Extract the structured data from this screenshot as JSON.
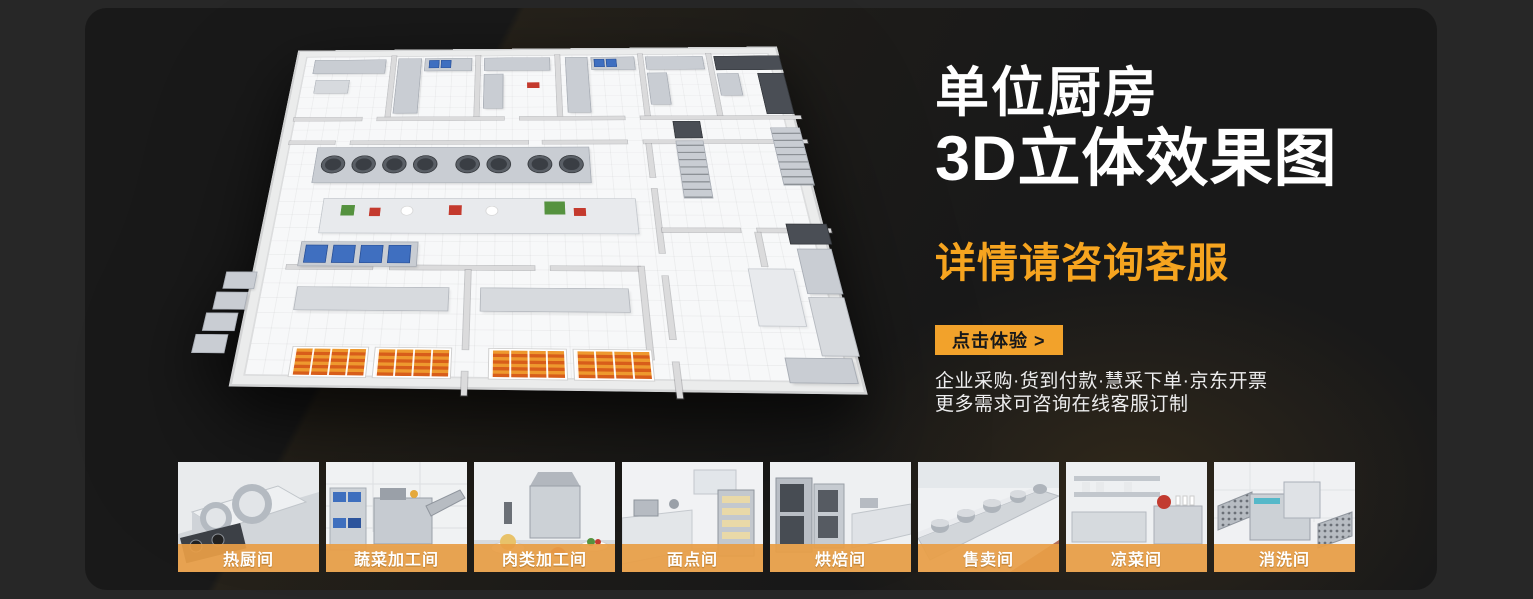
{
  "hero": {
    "title_line1": "单位厨房",
    "title_line2": "3D立体效果图",
    "subtitle": "详情请咨询客服",
    "cta_label": "点击体验 >",
    "note_line1": "企业采购·货到付款·慧采下单·京东开票",
    "note_line2": "更多需求可咨询在线客服订制"
  },
  "thumbnails": [
    {
      "label": "热厨间"
    },
    {
      "label": "蔬菜加工间"
    },
    {
      "label": "肉类加工间"
    },
    {
      "label": "面点间"
    },
    {
      "label": "烘焙间"
    },
    {
      "label": "售卖间"
    },
    {
      "label": "凉菜间"
    },
    {
      "label": "消洗间"
    }
  ],
  "colors": {
    "accent_orange": "#F2A22B",
    "subtitle_orange": "#F6A41F",
    "label_bar_orange": "#E89E46",
    "page_background": "#272727",
    "panel_background": "#191919",
    "title_white": "#FFFFFF"
  }
}
